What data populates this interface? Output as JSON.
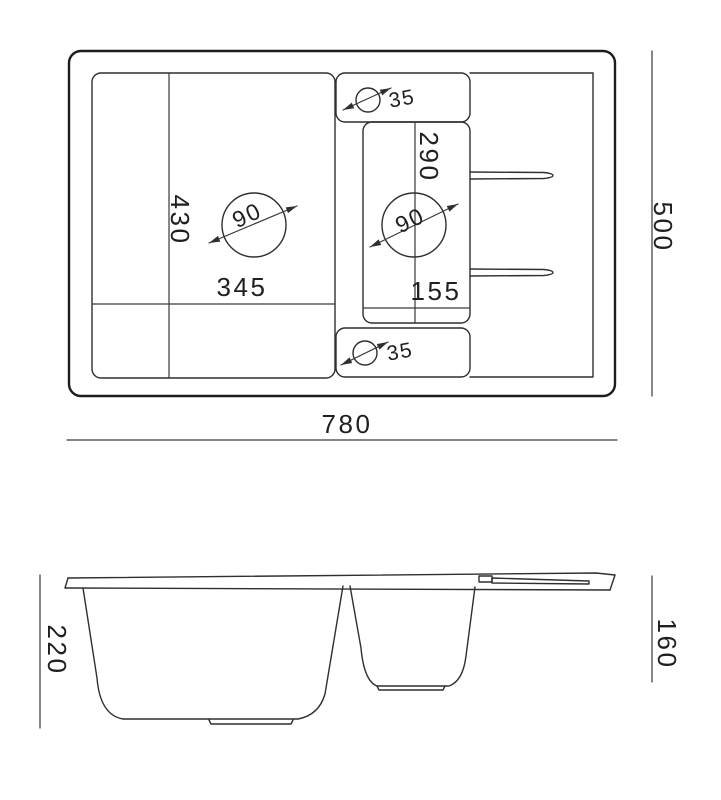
{
  "page": {
    "background": "#ffffff",
    "line_color": "#2f2f2f",
    "text_color": "#1f1f1f"
  },
  "plan_view": {
    "overall_width_mm": "780",
    "overall_depth_mm": "500",
    "main_bowl": {
      "width_mm": "345",
      "depth_mm": "430",
      "drain_diameter_mm": "90"
    },
    "small_bowl": {
      "width_mm": "155",
      "depth_mm": "290",
      "drain_diameter_mm": "90"
    },
    "tap_holes": {
      "top_diameter_mm": "35",
      "bottom_diameter_mm": "35"
    }
  },
  "side_view": {
    "main_bowl_depth_mm": "220",
    "small_bowl_depth_mm": "160"
  }
}
